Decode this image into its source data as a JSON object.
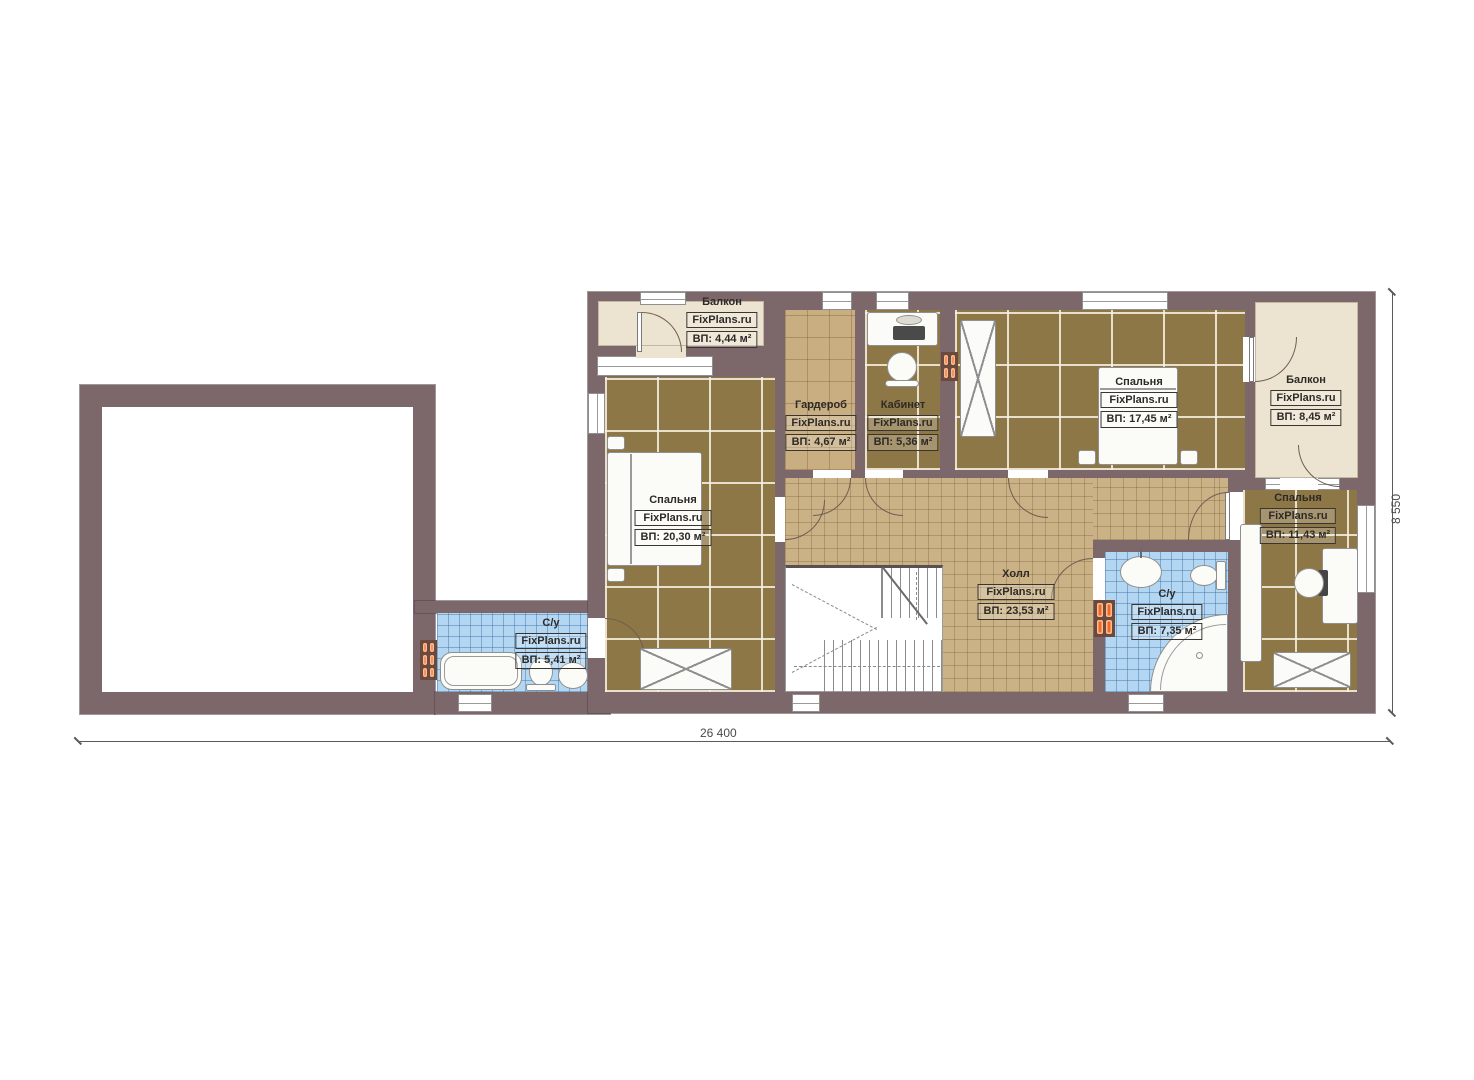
{
  "plan": {
    "title": "Floor plan, second floor",
    "watermark": "FixPlans.ru",
    "dimensions": {
      "bottom": "26 400",
      "right": "8 550"
    },
    "colors": {
      "wall": "#7c676b",
      "floor_dark": "#8d7746",
      "floor_tan": "#cbb286",
      "floor_blue": "#b3d7f2",
      "floor_beige": "#ece3d0",
      "radiator": "#f26a1e"
    },
    "rooms": [
      {
        "name": "Балкон",
        "site": "FixPlans.ru",
        "area": "ВП: 4,44 м²"
      },
      {
        "name": "Гардероб",
        "site": "FixPlans.ru",
        "area": "ВП: 4,67 м²"
      },
      {
        "name": "Кабинет",
        "site": "FixPlans.ru",
        "area": "ВП: 5,36 м²"
      },
      {
        "name": "Спальня",
        "site": "FixPlans.ru",
        "area": "ВП: 17,45 м²"
      },
      {
        "name": "Балкон",
        "site": "FixPlans.ru",
        "area": "ВП: 8,45 м²"
      },
      {
        "name": "Спальня",
        "site": "FixPlans.ru",
        "area": "ВП: 20,30 м²"
      },
      {
        "name": "Холл",
        "site": "FixPlans.ru",
        "area": "ВП: 23,53 м²"
      },
      {
        "name": "С/у",
        "site": "FixPlans.ru",
        "area": "ВП: 7,35 м²"
      },
      {
        "name": "Спальня",
        "site": "FixPlans.ru",
        "area": "ВП: 11,43 м²"
      },
      {
        "name": "С/у",
        "site": "FixPlans.ru",
        "area": "ВП: 5,41 м²"
      }
    ]
  }
}
